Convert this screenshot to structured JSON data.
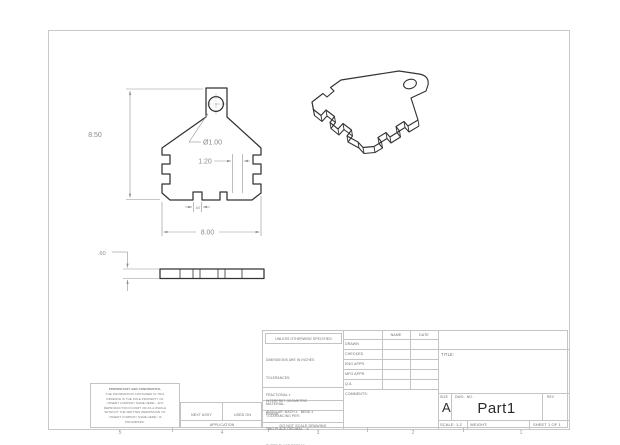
{
  "drawing": {
    "dims": {
      "front_height": "8.50",
      "hole": "Ø1.00",
      "notch_pos": "1.20",
      "notch_width": ".60",
      "front_width": "8.00",
      "thickness": ".60"
    },
    "zones": [
      "5",
      "4",
      "3",
      "2",
      "1"
    ],
    "title_block": {
      "unless": "UNLESS OTHERWISE SPECIFIED:",
      "tolerance_lines": [
        "DIMENSIONS ARE IN INCHES",
        "TOLERANCES:",
        "FRACTIONAL ±",
        "ANGULAR: MACH ±   BEND ±",
        "TWO PLACE DECIMAL    ±",
        "THREE PLACE DECIMAL  ±"
      ],
      "interpret_lines": [
        "INTERPRET GEOMETRIC",
        "TOLERANCING PER:"
      ],
      "material": "MATERIAL",
      "finish": "FINISH",
      "do_not_scale": "DO NOT SCALE DRAWING",
      "name": "NAME",
      "date": "DATE",
      "approval_rows": [
        "DRAWN",
        "CHECKED",
        "ENG APPR.",
        "MFG APPR.",
        "Q.A.",
        "COMMENTS:"
      ],
      "title_label": "TITLE:",
      "size_label": "SIZE",
      "size": "A",
      "dwg_label": "DWG.  NO.",
      "dwg_no": "Part1",
      "rev_label": "REV",
      "scale": "SCALE: 1:2",
      "weight": "WEIGHT:",
      "sheet": "SHEET 1 OF 1"
    },
    "application": {
      "next_assy": "NEXT ASSY",
      "used_on": "USED ON",
      "label": "APPLICATION"
    },
    "proprietary": {
      "heading": "PROPRIETARY AND CONFIDENTIAL",
      "lines": [
        "THE INFORMATION CONTAINED IN THIS",
        "DRAWING IS THE SOLE PROPERTY OF",
        "<INSERT COMPANY NAME HERE>. ANY",
        "REPRODUCTION IN PART OR AS A WHOLE",
        "WITHOUT THE WRITTEN PERMISSION OF",
        "<INSERT COMPANY NAME HERE> IS",
        "PROHIBITED."
      ]
    },
    "colors": {
      "edge": "#333333",
      "dim": "#8a8a8a",
      "frame": "#c8c8c8",
      "title_block_line": "#c4c4c4",
      "title_block_text": "#6e6e6e"
    }
  }
}
